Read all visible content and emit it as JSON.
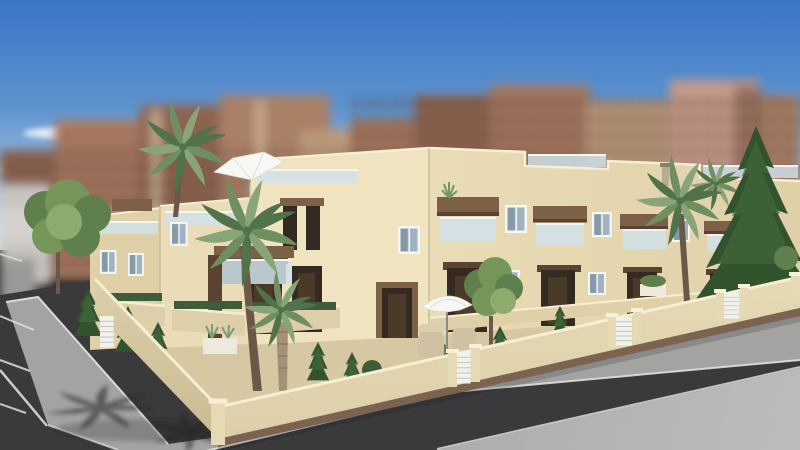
{
  "scene": {
    "kind": "3d-architectural-render",
    "subject": "two-storey cream townhouse block with roof terraces on a street corner",
    "setting": "blurred apartment towers behind, blue sky with thin clouds, palm trees, corner garden wall, asphalt streets with parking bays and pale pavements",
    "objects": [
      "sky",
      "clouds",
      "apartment-towers",
      "townhouse-block",
      "roof-terrace",
      "roof-parasol",
      "wood-lintels",
      "balconies",
      "windows",
      "doors",
      "perimeter-wall",
      "gates",
      "palm-trees",
      "pine-tree",
      "garden-trees",
      "bushes",
      "planters",
      "patio-parasol",
      "wicker-chairs",
      "road",
      "parking-lines",
      "pavement",
      "palm-shadow"
    ]
  },
  "colors": {
    "sky-top": "#3a76c6",
    "sky-mid": "#5e93cf",
    "sky-low": "#a9c8e4",
    "sky-horizon": "#cfe0ee",
    "cloud-white": "#ffffff",
    "tower-brown-1": "#8c6450",
    "tower-brown-2": "#a4765f",
    "tower-brown-3": "#a98066",
    "tower-tan": "#b99879",
    "tower-pink": "#c49a8a",
    "tower-light": "#d9c2a6",
    "tower-window": "#4e352b",
    "distant-grey": "#c9c5c0",
    "facade-lit": "#f0e3bf",
    "facade-mid": "#e9dcb6",
    "facade-shade": "#dfd0a8",
    "facade-edge": "#cdbc94",
    "parapet-cap": "#f7efd4",
    "wood-trim": "#7c6146",
    "wood-dark": "#5a4431",
    "porch-recess": "#332a22",
    "door": "#4a3a28",
    "window-frame": "#f6f6f2",
    "window-glass": "#9fb2c2",
    "window-glass-dark": "#6c7f8f",
    "balcony-glass": "#cfe2ec",
    "railing-white": "#f4f6f6",
    "garden-wall": "#dccfa9",
    "garden-wall-lit": "#e6dab4",
    "wall-plinth": "#7b6350",
    "gate-white": "#f1f1ed",
    "gate-slat": "#c4c4bf",
    "road-asphalt": "#3a3a3c",
    "pavement": "#a3a3a1",
    "pavement-light": "#bcbcba",
    "curb-white": "#e6e6e4",
    "parking-line": "#dededc",
    "palm-green-1": "#6f8f63",
    "palm-green-2": "#51724b",
    "palm-green-3": "#88a478",
    "palm-trunk": "#6a5948",
    "palm-trunk-light": "#a39276",
    "pine-dark": "#33532f",
    "pine-light": "#41663b",
    "tree-green-1": "#5f7f4c",
    "tree-green-2": "#769559",
    "tree-green-3": "#8dab6c",
    "hedge": "#3e5c39",
    "cast-shadow": "#202024",
    "parasol-white": "#f7f7f3",
    "parasol-rib": "#d9d9d4",
    "parasol-pole": "#8a8a86",
    "wicker-chair": "#cfc1a2",
    "wicker-chair-light": "#dbcfae",
    "planter-white": "#eee9dc",
    "garden-ground": "#d5c8a3",
    "chimney": "#b8ab90"
  }
}
